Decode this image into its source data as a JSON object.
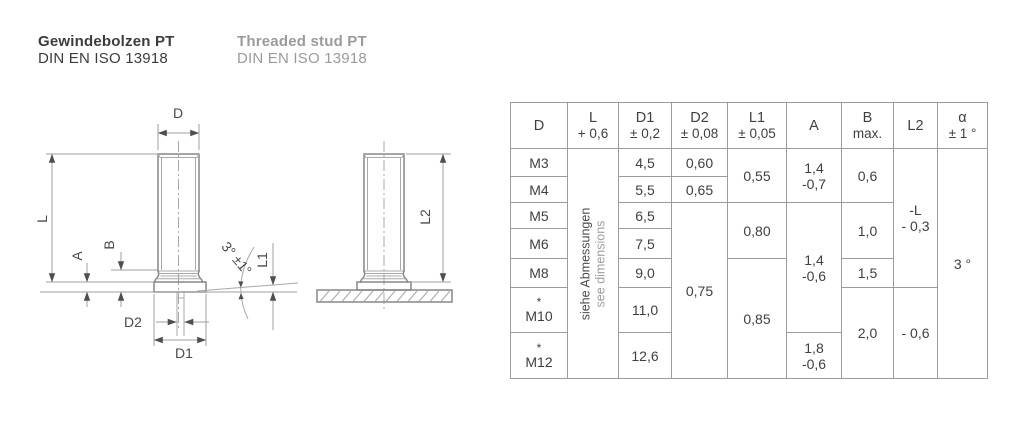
{
  "header": {
    "de_title": "Gewindebolzen PT",
    "de_standard": "DIN EN ISO 13918",
    "en_title": "Threaded stud PT",
    "en_standard": "DIN EN ISO 13918"
  },
  "drawing": {
    "front_view": {
      "dim_d": "D",
      "dim_l": "L",
      "dim_a": "A",
      "dim_b": "B",
      "dim_d2": "D2",
      "dim_d1": "D1",
      "dim_l1": "L1",
      "angle": "3° ±1°"
    },
    "side_view": {
      "dim_l2": "L2"
    }
  },
  "table": {
    "header": [
      {
        "line1": "D",
        "line2": ""
      },
      {
        "line1": "L",
        "line2": "+ 0,6"
      },
      {
        "line1": "D1",
        "line2": "± 0,2"
      },
      {
        "line1": "D2",
        "line2": "± 0,08"
      },
      {
        "line1": "L1",
        "line2": "± 0,05"
      },
      {
        "line1": "A",
        "line2": ""
      },
      {
        "line1": "B",
        "line2": "max."
      },
      {
        "line1": "L2",
        "line2": ""
      },
      {
        "line1": "α",
        "line2": "± 1 °"
      }
    ],
    "l_note": {
      "de": "siehe Abmessungen",
      "en": "see dimensions"
    },
    "rows": {
      "m3": {
        "d": "M3",
        "d1": "4,5",
        "d2": "0,60"
      },
      "m4": {
        "d": "M4",
        "d1": "5,5",
        "d2": "0,65"
      },
      "m5": {
        "d": "M5",
        "d1": "6,5"
      },
      "m6": {
        "d": "M6",
        "d1": "7,5"
      },
      "m8": {
        "d": "M8",
        "d1": "9,0"
      },
      "m10": {
        "star": "*",
        "d": "M10",
        "d1": "11,0"
      },
      "m12": {
        "star": "*",
        "d": "M12",
        "d1": "12,6"
      }
    },
    "merged": {
      "d2_m5_m12": "0,75",
      "l1_m3_m4": "0,55",
      "l1_m5_m6": "0,80",
      "l1_m8_m12": "0,85",
      "a_m3_m4": "1,4\n-0,7",
      "a_m5_m10": "1,4\n-0,6",
      "a_m12": "1,8\n-0,6",
      "b_m3_m4": "0,6",
      "b_m5_m6": "1,0",
      "b_m8": "1,5",
      "b_m10_m12": "2,0",
      "l2_m3_m8": "-L\n- 0,3",
      "l2_m10_m12": "- 0,6",
      "alpha_all": "3 °"
    }
  },
  "colors": {
    "part_line": "#878787",
    "dim_line": "#9f9f9f",
    "text_dark": "#3f3f3f",
    "text_gray": "#9b9b9b",
    "table_border": "#9c9c9c"
  }
}
